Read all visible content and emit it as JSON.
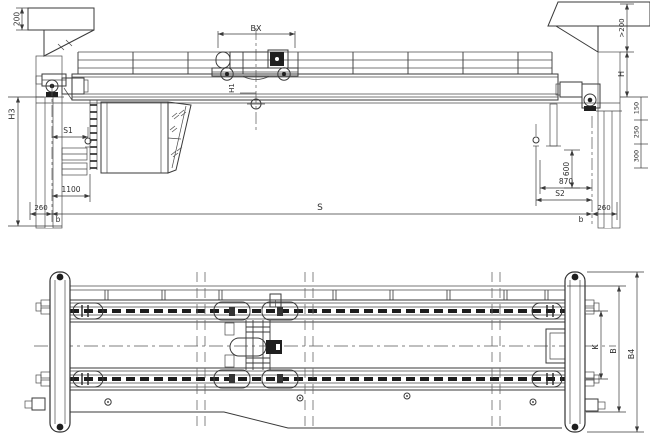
{
  "colors": {
    "line": "#3a3a3a",
    "dark": "#1f1f1f",
    "background": "#ffffff"
  },
  "elevation": {
    "dims": {
      "d200": "200",
      "bx": "BX",
      "h1": "H1",
      "h3": "H3",
      "s1": "S1",
      "d1100": "1100",
      "d260_left": "260",
      "b_left": "b",
      "s": "S",
      "d600": "600",
      "d870": "870",
      "s2": "S2",
      "b_right": "b",
      "d260_right": "260",
      "gt200": ">200",
      "h": "H",
      "stack": [
        "150",
        "250",
        "300"
      ]
    }
  },
  "plan": {
    "dims": {
      "k": "K",
      "b": "B",
      "b4": "B4"
    }
  }
}
